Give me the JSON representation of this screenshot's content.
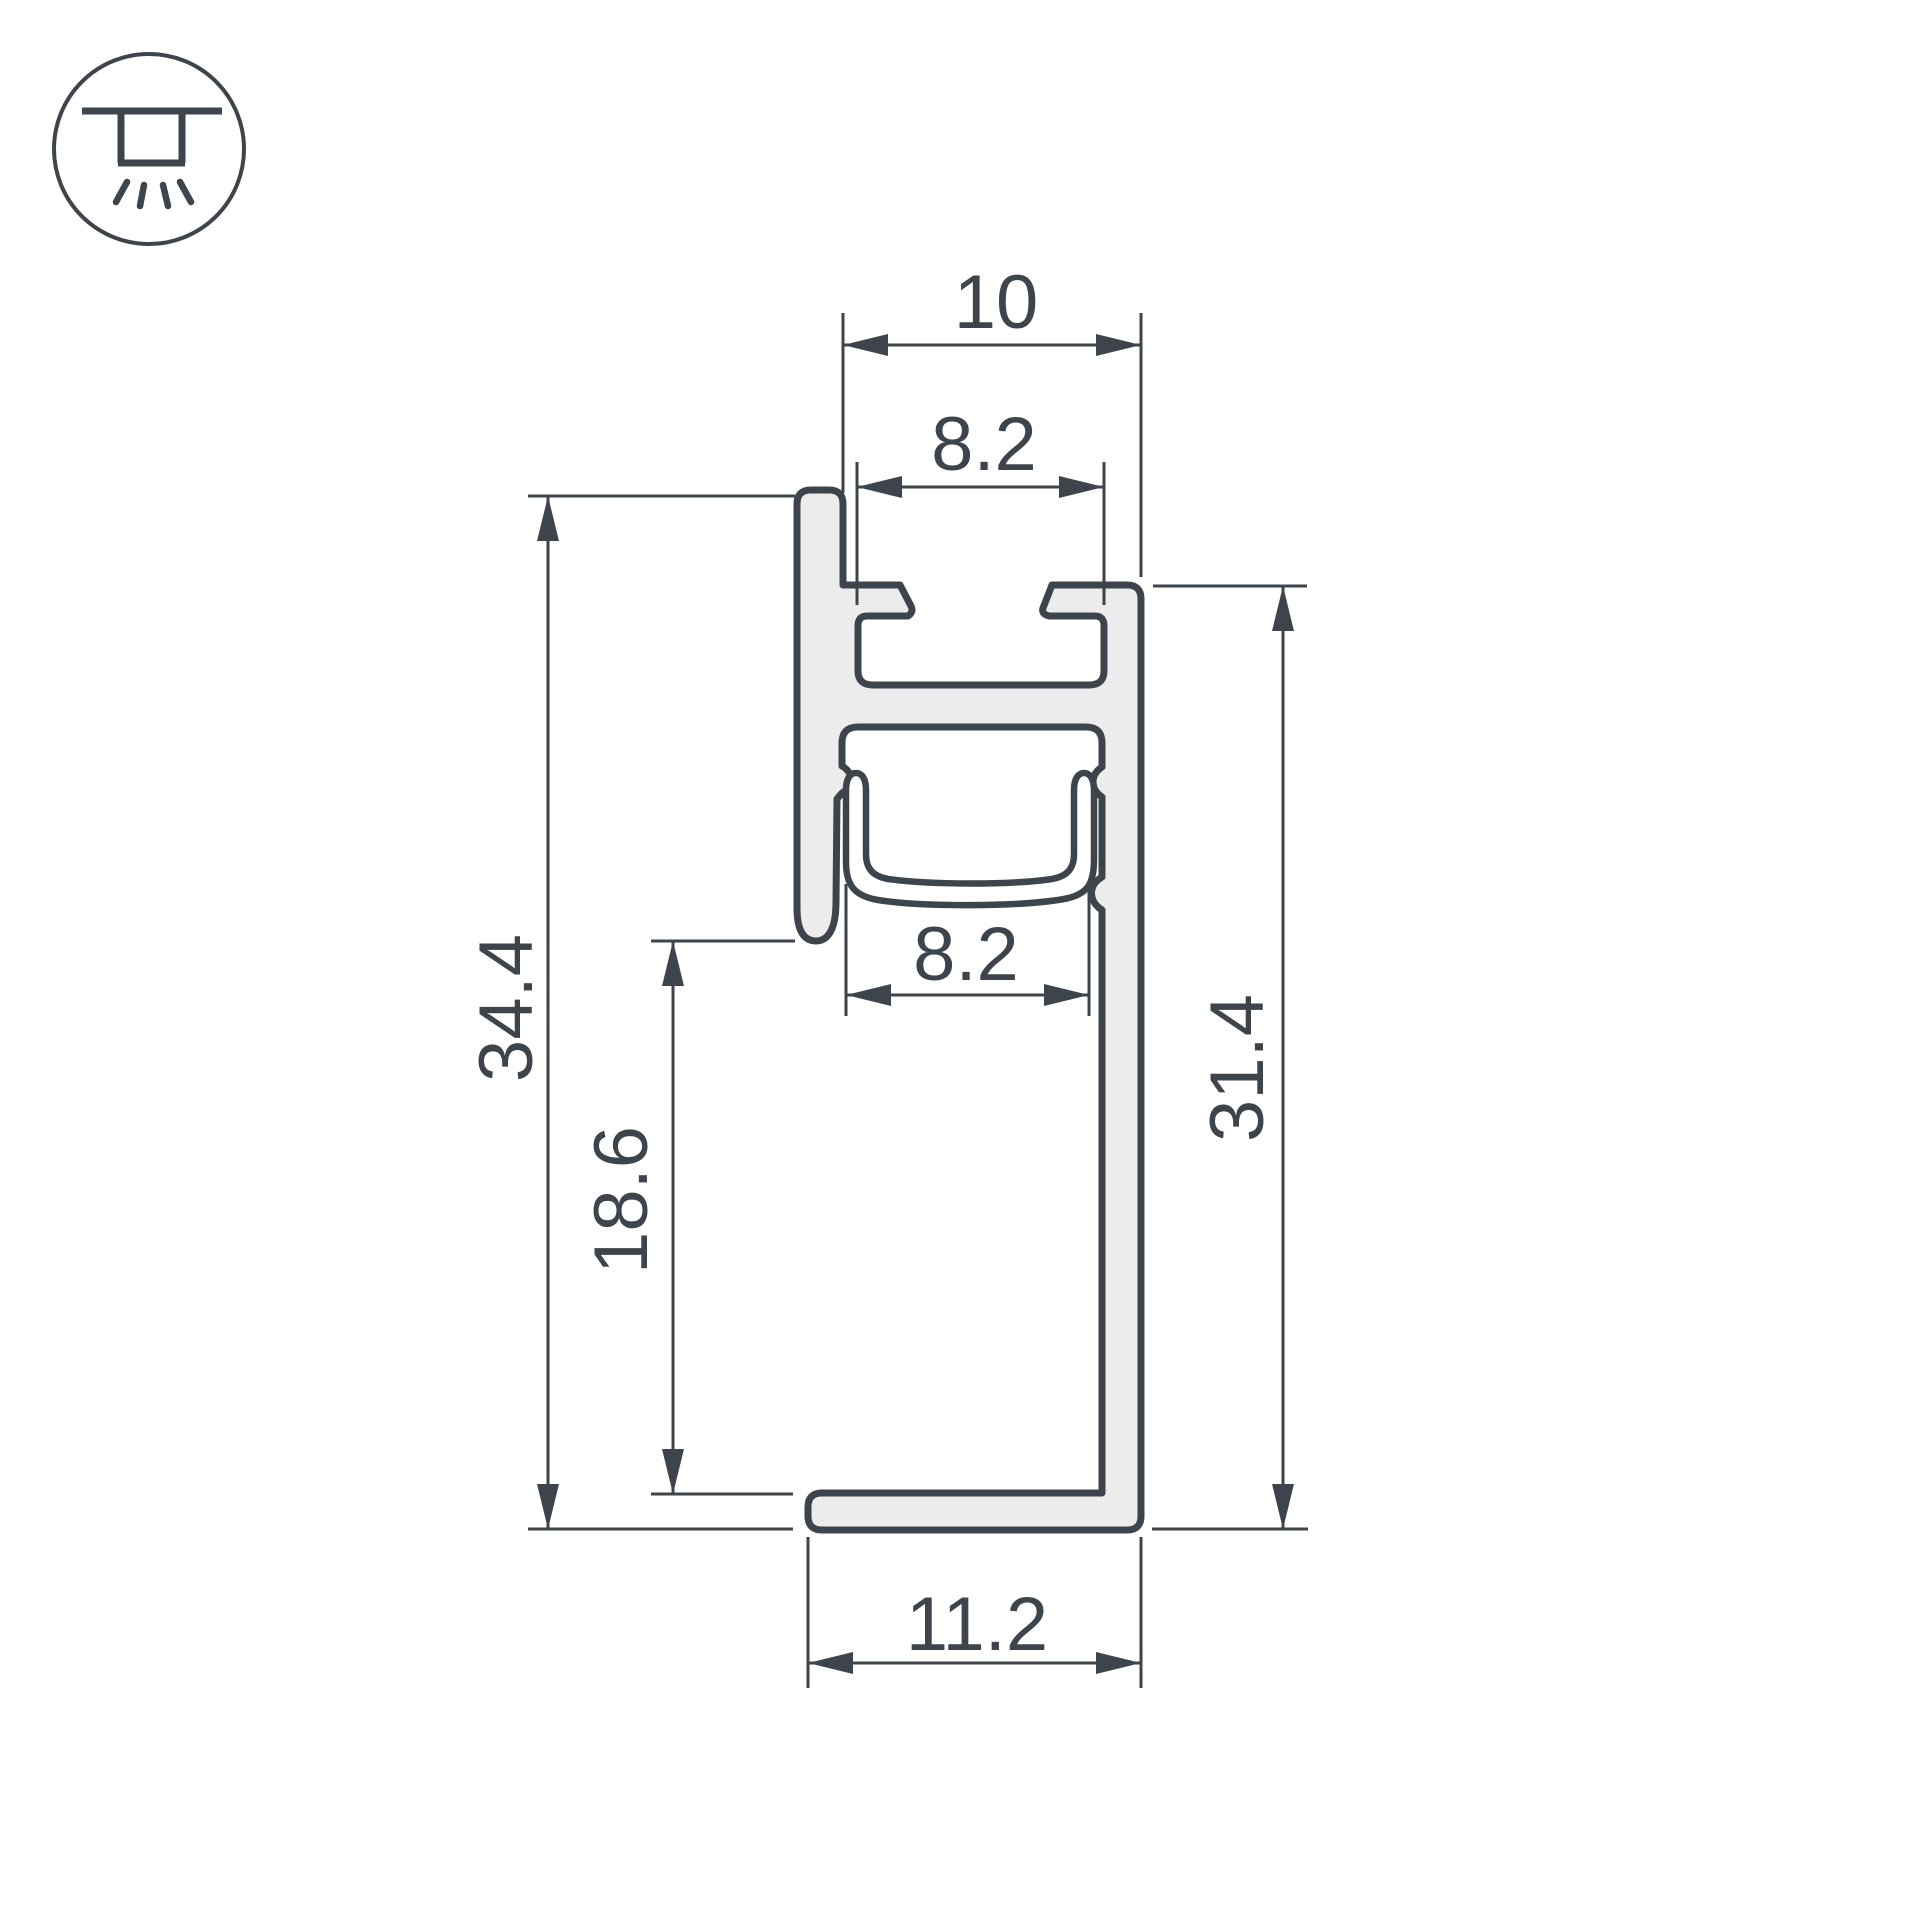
{
  "colors": {
    "line": "#3d444b",
    "aluminum_fill": "#ececec",
    "background": "#ffffff"
  },
  "icon": {
    "name": "recessed-ceiling-downlight-icon"
  },
  "dimensions": {
    "top_outer_width": {
      "label": "10"
    },
    "top_inner_width": {
      "label": "8.2"
    },
    "led_opening_width": {
      "label": "8.2"
    },
    "total_height": {
      "label": "34.4"
    },
    "lower_clearance_height": {
      "label": "18.6"
    },
    "right_side_height": {
      "label": "31.4"
    },
    "bottom_flange_width": {
      "label": "11.2"
    }
  }
}
